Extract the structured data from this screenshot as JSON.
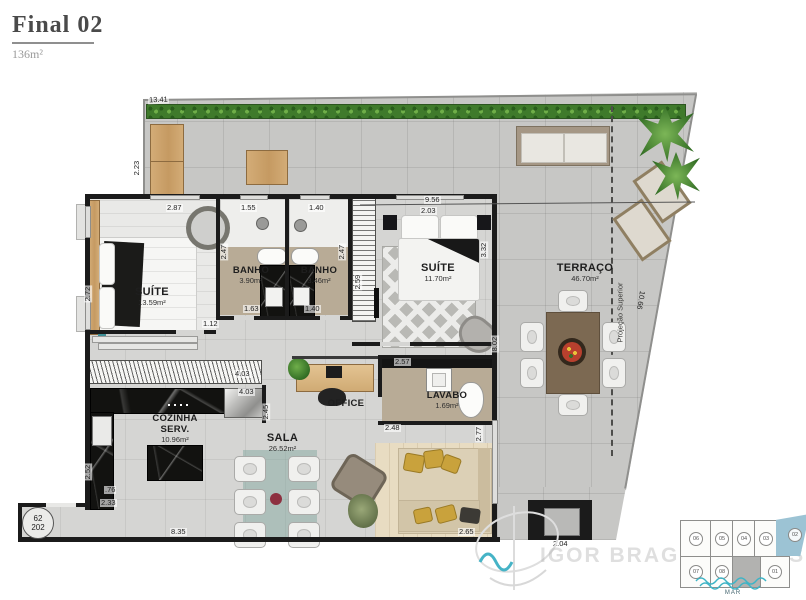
{
  "header": {
    "title": "Final 02",
    "area": "136m²"
  },
  "rooms": {
    "suite1": {
      "name": "SUÍTE",
      "area": "13.59m²"
    },
    "banho1": {
      "name": "BANHO",
      "area": "3.90m²"
    },
    "banho2": {
      "name": "BANHO",
      "area": "3.46m²"
    },
    "suite2": {
      "name": "SUÍTE",
      "area": "11.70m²"
    },
    "terraco": {
      "name": "TERRAÇO",
      "area": "46.70m²"
    },
    "office": {
      "name": "OFFICE"
    },
    "lavabo": {
      "name": "LAVABO",
      "area": "1.69m²"
    },
    "cozinha": {
      "name": "COZINHA",
      "name2": "SERV.",
      "area": "10.96m²"
    },
    "sala": {
      "name": "SALA",
      "area": "26.52m²"
    }
  },
  "dims": {
    "terrace_top": "13.41",
    "terrace_left": "2.23",
    "suites_row_top": "9.56",
    "suite1_top": "2.87",
    "banho1_top": "1.55",
    "banho2_top": "1.40",
    "suite2_top": "2.03",
    "banho1_left": "2.47",
    "banho2_right": "2.47",
    "suite2_right": "3.32",
    "suite1_left": "2.72",
    "closet_left": "2.59",
    "suite1_bottom": "1.12",
    "banho1_bottom": "1.63",
    "banho2_bottom": "1.40",
    "wardrobe": "4.03",
    "kitchen_top": "4.03",
    "kitchen_right": "2.45",
    "office_top": "2.57",
    "hall_right": "8.02",
    "office_bottom": "2.48",
    "kitchen_left": "2.52",
    "entry_a": ".76",
    "entry_b": "2.33",
    "sala_right": "2.77",
    "sofa_bottom": "2.65",
    "bottom": "8.35",
    "tv_wall": "2.04",
    "terrace_diagonal": "10.66"
  },
  "annotations": {
    "projection": "Projeção Superior",
    "unit_floor": "62",
    "unit_number": "202"
  },
  "branding": {
    "watermark": "IGOR BRAGA IMÓVEIS"
  },
  "keyplan": {
    "units": [
      "06",
      "05",
      "04",
      "03",
      "02",
      "07",
      "08",
      "01"
    ],
    "highlighted": "02",
    "sea": "MAR"
  },
  "colors": {
    "keyplan_highlight": "#9cc3d4",
    "sea_wave": "#3db4c6",
    "hedge_green": "#3f7a2b",
    "wall_black": "#1b1b1b"
  }
}
